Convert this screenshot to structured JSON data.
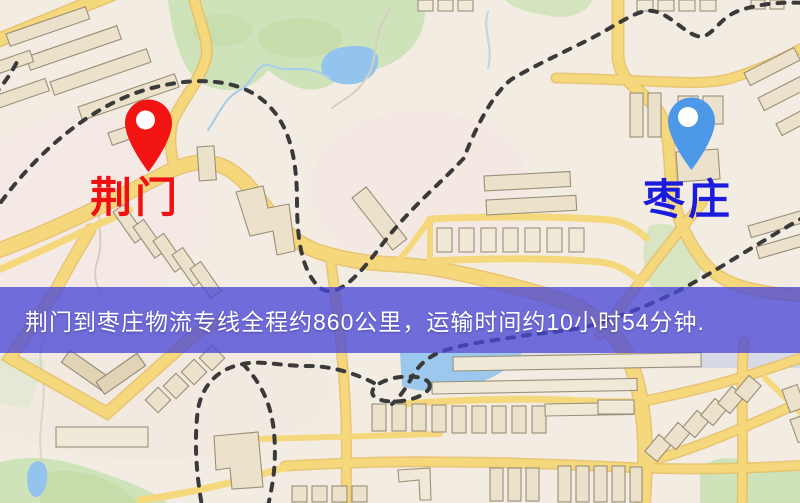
{
  "map": {
    "origin": {
      "label": "荆门",
      "pin_color": "#f21313",
      "label_color": "#f01010"
    },
    "destination": {
      "label": "枣庄",
      "pin_color": "#4d99e8",
      "label_color": "#1b1bdd"
    },
    "banner": {
      "text": "荆门到枣庄物流专线全程约860公里，运输时间约10小时54分钟.",
      "bg_color": "rgba(74,72,214,0.78)",
      "text_color": "#ffffff",
      "route_distance_km": "860",
      "duration_hours": "10",
      "duration_minutes": "54"
    },
    "palette": {
      "road": "#f6d87c",
      "road_casing": "#e6bd62",
      "building": "#ece1cb",
      "park": "#cfe3ba",
      "water": "#92c4ee",
      "railway": "#3a3a3a",
      "base": "#f3ece2"
    }
  }
}
